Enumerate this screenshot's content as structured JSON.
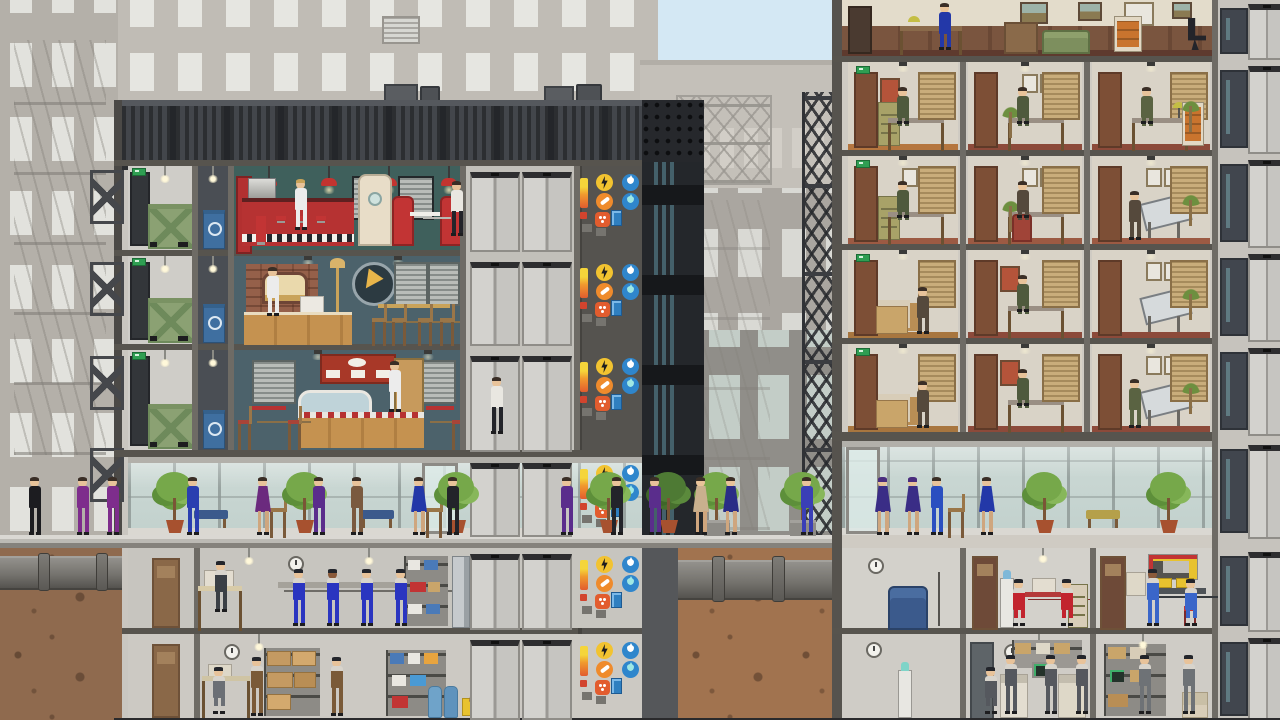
{
  "meta": {
    "game_view": "skyscraper-cross-section",
    "style": "flat-vector-simulation"
  },
  "palette": {
    "sky": "#d4e8f4",
    "bg_building": "#b7b3ac",
    "bg_window": "#e3e3de",
    "frame_gray": "#6e6b65",
    "separator": "#57544e",
    "mech_dark": "#34363a",
    "dirt_left": "#8f6a4e",
    "dirt_mid": "#a1734f",
    "diner_wall": "#3f605c",
    "pizza_wall": "#4c626b",
    "deli_wall": "#4c626b",
    "office_wall": "#d9d3c7",
    "accent_red": "#b63232",
    "wood": "#c59250",
    "power_yellow": "#f2c330",
    "phone_orange": "#ef8b2c",
    "fire_orange": "#e25c2e",
    "water_blue": "#2f86cc",
    "exit_green": "#2f9e52",
    "dumpster_green": "#8ba173",
    "recycle_blue": "#3f6fa0"
  },
  "left_tower": {
    "floors": [
      {
        "id": "mech",
        "label": "mechanical-floor"
      },
      {
        "id": "f3",
        "label": "diner-restaurant"
      },
      {
        "id": "f2",
        "label": "pizzeria-restaurant"
      },
      {
        "id": "f1",
        "label": "deli-restaurant"
      },
      {
        "id": "lobby",
        "label": "ground-lobby"
      },
      {
        "id": "b1",
        "label": "basement-workshop"
      },
      {
        "id": "b2",
        "label": "basement-storage"
      }
    ],
    "floor_spans": [
      [
        166,
        250
      ],
      [
        256,
        344
      ],
      [
        350,
        450
      ],
      [
        457,
        535
      ],
      [
        548,
        628
      ],
      [
        634,
        718
      ]
    ],
    "service_floor_spans": [
      [
        166,
        250
      ],
      [
        256,
        344
      ],
      [
        350,
        450
      ]
    ],
    "elevator_x": [
      470,
      522
    ],
    "utility_x": 578,
    "utility_icons": [
      "power-icon",
      "phone-icon",
      "fire-icon",
      "water-cold-icon",
      "water-hot-icon",
      "water-meter"
    ]
  },
  "right_tower": {
    "corridor_floor_spans": [
      [
        0,
        56
      ],
      [
        62,
        150
      ],
      [
        156,
        244
      ],
      [
        250,
        338
      ],
      [
        344,
        432
      ],
      [
        441,
        535
      ],
      [
        548,
        628
      ],
      [
        634,
        718
      ]
    ],
    "dark_door_x": 1220,
    "elevator_x": 1248,
    "office_rows": [
      {
        "top": 62,
        "offices": [
          {
            "x": 848,
            "w": 110,
            "accent": "#b5763f",
            "suit": "#4f5a3d",
            "items": [
              "door",
              "exit",
              "poster",
              "cabinet-olive",
              "desk-person",
              "blinds"
            ]
          },
          {
            "x": 968,
            "w": 114,
            "accent": "#8c4a3a",
            "suit": "#4f5a3d",
            "items": [
              "door",
              "plant-sm",
              "frames",
              "desk-person",
              "blinds"
            ]
          },
          {
            "x": 1092,
            "w": 118,
            "accent": "#8c4a3a",
            "suit": "#5a6342",
            "items": [
              "door",
              "blinds",
              "desk-person",
              "palm",
              "cabinet-orange"
            ]
          }
        ]
      },
      {
        "top": 156,
        "offices": [
          {
            "x": 848,
            "w": 110,
            "accent": "#9c5a43",
            "suit": "#4f5a3d",
            "items": [
              "door",
              "exit",
              "cabinet-olive",
              "desk-person",
              "frames",
              "blinds"
            ]
          },
          {
            "x": 968,
            "w": 114,
            "accent": "#9c5a43",
            "suit": "#55493c",
            "items": [
              "door",
              "plant-sm",
              "frames",
              "desk-person",
              "chair-red",
              "blinds"
            ]
          },
          {
            "x": 1092,
            "w": 118,
            "accent": "#9c5a43",
            "suit": "#55493c",
            "items": [
              "door",
              "frames",
              "drafting-person",
              "palm",
              "blinds"
            ]
          }
        ]
      },
      {
        "top": 250,
        "offices": [
          {
            "x": 848,
            "w": 110,
            "accent": "#a8763f",
            "suit": "#55493c",
            "items": [
              "door",
              "exit",
              "boxes",
              "worker-standing",
              "blinds"
            ]
          },
          {
            "x": 968,
            "w": 114,
            "accent": "#8c4a3a",
            "suit": "#4f5a3d",
            "items": [
              "door",
              "poster",
              "desk-person",
              "blinds"
            ]
          },
          {
            "x": 1092,
            "w": 118,
            "accent": "#8c4a3a",
            "suit": "#55493c",
            "items": [
              "door",
              "frames",
              "drafting",
              "palm",
              "blinds"
            ]
          }
        ]
      },
      {
        "top": 344,
        "offices": [
          {
            "x": 848,
            "w": 110,
            "accent": "#a8763f",
            "suit": "#55493c",
            "items": [
              "door",
              "exit",
              "boxes",
              "worker-standing",
              "blinds"
            ]
          },
          {
            "x": 968,
            "w": 114,
            "accent": "#8c4a3a",
            "suit": "#4f5a3d",
            "items": [
              "door",
              "poster",
              "desk-person",
              "blinds"
            ]
          },
          {
            "x": 1092,
            "w": 118,
            "accent": "#8c4a3a",
            "suit": "#5a6342",
            "items": [
              "door",
              "frames",
              "drafting-person",
              "palm",
              "blinds"
            ]
          }
        ]
      }
    ]
  },
  "people": [
    {
      "x": 28,
      "c": "#1c1c20"
    },
    {
      "x": 76,
      "c": "#7e2d8c"
    },
    {
      "x": 106,
      "c": "#7e2d8c"
    },
    {
      "x": 186,
      "c": "#2a3fb0"
    },
    {
      "x": 256,
      "c": "#6b2a7e",
      "d": 1
    },
    {
      "x": 312,
      "c": "#5a2d8c"
    },
    {
      "x": 350,
      "c": "#7a5a3f"
    },
    {
      "x": 412,
      "c": "#2338a8",
      "d": 1
    },
    {
      "x": 446,
      "c": "#23242a"
    },
    {
      "x": 560,
      "c": "#5a2d8c"
    },
    {
      "x": 610,
      "c": "#23242a"
    },
    {
      "x": 648,
      "c": "#5a2d8c"
    },
    {
      "x": 694,
      "c": "#c9b08e",
      "d": 1
    },
    {
      "x": 724,
      "c": "#2a2d86",
      "d": 1
    },
    {
      "x": 800,
      "c": "#3a3fb6"
    },
    {
      "x": 876,
      "c": "#3a2d86",
      "d": 1,
      "hat": 1
    },
    {
      "x": 906,
      "c": "#3a2d86",
      "d": 1,
      "hat": 1
    },
    {
      "x": 930,
      "c": "#2a4fc0"
    },
    {
      "x": 980,
      "c": "#2338a8",
      "d": 1
    },
    {
      "x": 294,
      "y": 180,
      "h": 50,
      "c": "#ececec",
      "hair": "#c9a35a"
    },
    {
      "x": 450,
      "y": 182,
      "h": 54,
      "c": "#e9e7e1",
      "pants": "#23242a"
    },
    {
      "x": 266,
      "y": 268,
      "h": 48,
      "c": "#ececec"
    },
    {
      "x": 388,
      "y": 362,
      "h": 50,
      "c": "#ececec"
    },
    {
      "x": 490,
      "y": 378,
      "h": 56,
      "c": "#e9e7e1",
      "pants": "#23242a"
    },
    {
      "x": 214,
      "y": 562,
      "h": 50,
      "c": "#3a3f45",
      "worker": 1
    },
    {
      "x": 292,
      "y": 570,
      "h": 56,
      "c": "#2a35c0",
      "worker": 1
    },
    {
      "x": 326,
      "y": 570,
      "h": 56,
      "c": "#2a35c0",
      "worker": 1,
      "skin": "#8a5a3a"
    },
    {
      "x": 360,
      "y": 570,
      "h": 56,
      "c": "#2a35c0",
      "worker": 1
    },
    {
      "x": 394,
      "y": 570,
      "h": 56,
      "c": "#2a35c0",
      "worker": 1
    },
    {
      "x": 1012,
      "y": 580,
      "h": 46,
      "c": "#c2242e",
      "worker": 1,
      "seated": 1
    },
    {
      "x": 1060,
      "y": 580,
      "h": 46,
      "c": "#c2242e",
      "worker": 1,
      "seated": 1
    },
    {
      "x": 1146,
      "y": 570,
      "h": 56,
      "c": "#3a66c9",
      "worker": 1,
      "skin": "#8a5a3a"
    },
    {
      "x": 1184,
      "y": 580,
      "h": 46,
      "c": "#3a66c9",
      "worker": 1,
      "seated": 1
    },
    {
      "x": 212,
      "y": 668,
      "h": 46,
      "c": "#6b6f75",
      "worker": 1,
      "seated": 1
    },
    {
      "x": 250,
      "y": 658,
      "h": 58,
      "c": "#7a5a38",
      "worker": 1
    },
    {
      "x": 330,
      "y": 658,
      "h": 58,
      "c": "#7a5a38",
      "worker": 1
    },
    {
      "x": 984,
      "y": 668,
      "h": 46,
      "c": "#55585e",
      "worker": 1,
      "seated": 1
    },
    {
      "x": 1004,
      "y": 656,
      "h": 58,
      "c": "#55585e",
      "worker": 1
    },
    {
      "x": 1044,
      "y": 656,
      "h": 58,
      "c": "#55585e",
      "worker": 1
    },
    {
      "x": 1075,
      "y": 656,
      "h": 58,
      "c": "#55585e",
      "worker": 1
    },
    {
      "x": 1138,
      "y": 656,
      "h": 58,
      "c": "#6e7276",
      "worker": 1
    },
    {
      "x": 1182,
      "y": 656,
      "h": 58,
      "c": "#6e7276",
      "worker": 1
    }
  ],
  "street": {
    "trees": [
      {
        "x": 158
      },
      {
        "x": 288
      },
      {
        "x": 440
      },
      {
        "x": 592
      },
      {
        "x": 652,
        "dark": 1
      },
      {
        "x": 700,
        "planter": 1
      },
      {
        "x": 786,
        "planter": 1
      },
      {
        "x": 1028
      },
      {
        "x": 1152
      }
    ],
    "benches": [
      {
        "x": 194,
        "c": "#3b5a8c"
      },
      {
        "x": 360,
        "c": "#3b5a8c"
      },
      {
        "x": 1086,
        "c": "#b5a04a"
      }
    ],
    "chairs": [
      {
        "x": 270
      },
      {
        "x": 426
      },
      {
        "x": 948
      }
    ]
  }
}
